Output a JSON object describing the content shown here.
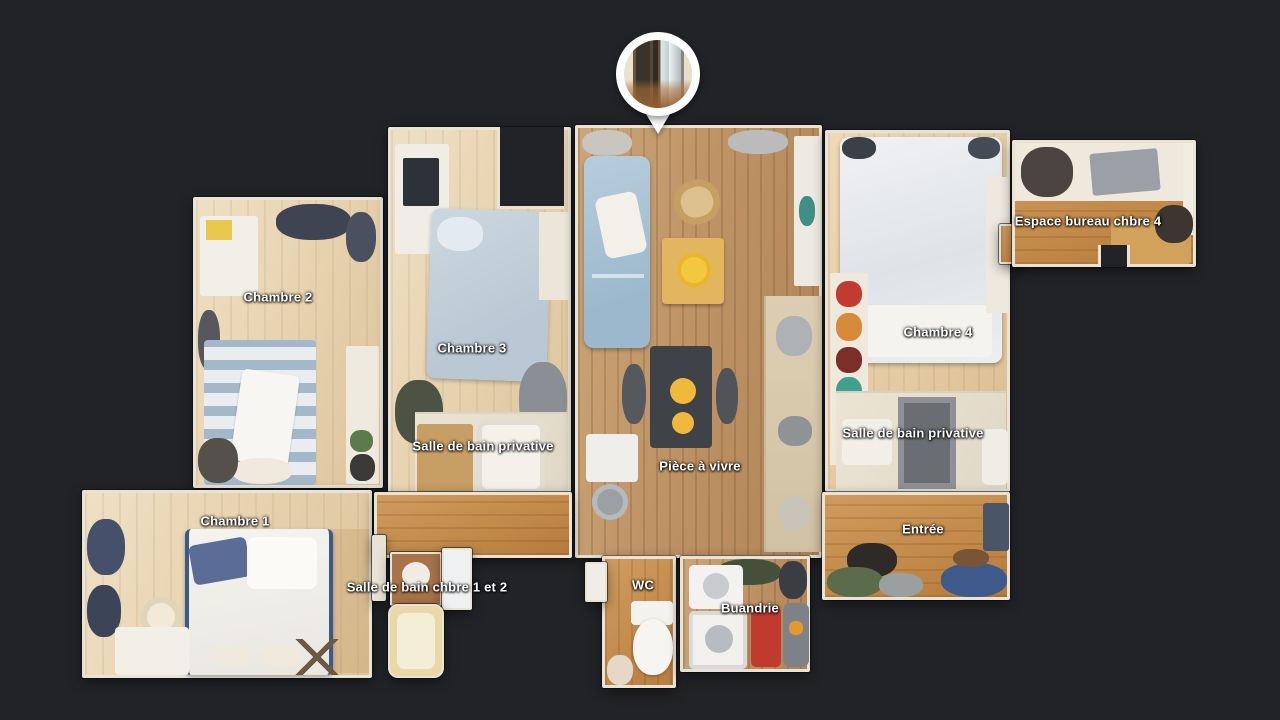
{
  "view": {
    "name": "Dollhouse top-down floor plan",
    "background_color": "#212327",
    "wall_color": "#e9e3d6",
    "label_text_color": "#ffffff"
  },
  "pin": {
    "name": "panorama-location-pin",
    "thumbnail": "interior photo: sliding glass doors to balcony"
  },
  "rooms": [
    {
      "id": "chambre-2",
      "label": "Chambre 2"
    },
    {
      "id": "chambre-3",
      "label": "Chambre 3"
    },
    {
      "id": "sdb-privative-ch3",
      "label": "Salle de bain privative"
    },
    {
      "id": "piece-a-vivre",
      "label": "Pièce à vivre"
    },
    {
      "id": "chambre-4",
      "label": "Chambre 4"
    },
    {
      "id": "sdb-privative-ch4",
      "label": "Salle de bain privative"
    },
    {
      "id": "espace-bureau-chbre-4",
      "label": "Espace bureau chbre 4"
    },
    {
      "id": "chambre-1",
      "label": "Chambre 1"
    },
    {
      "id": "sdb-chbre-1-et-2",
      "label": "Salle de bain chbre 1 et 2"
    },
    {
      "id": "wc",
      "label": "WC"
    },
    {
      "id": "buandrie",
      "label": "Buandrie"
    },
    {
      "id": "entree",
      "label": "Entrée"
    }
  ],
  "palette": {
    "wood_pale": "#e6d1ad",
    "wood_medium": "#bd9265",
    "wood_orange": "#c38a4c",
    "sofa_blue": "#a9c2d6",
    "table_yellow": "#e2b55e",
    "accent_red": "#c03a2e"
  }
}
